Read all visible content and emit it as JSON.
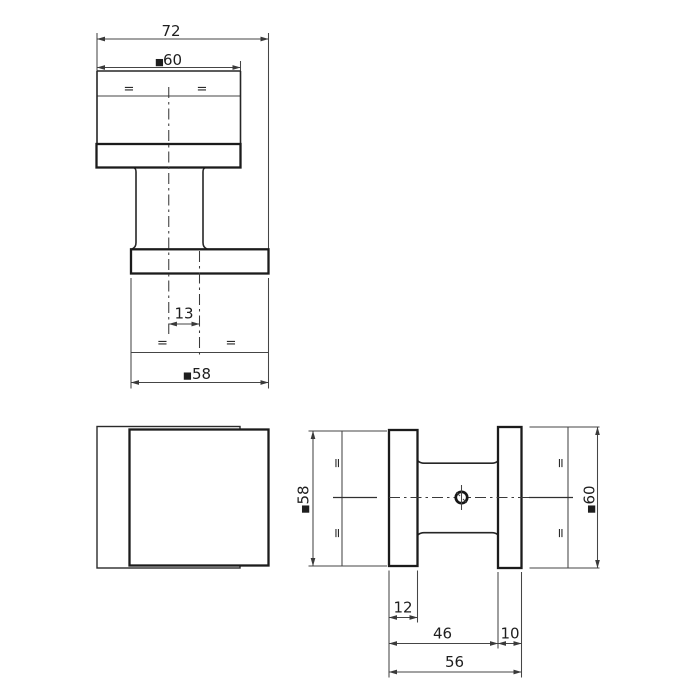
{
  "colors": {
    "background": "#ffffff",
    "object_line": "#1b1b1b",
    "dimension_line": "#454545",
    "text": "#1e1e1e"
  },
  "views": {
    "top_view": {
      "dims": {
        "overall_width": "72",
        "square_sym": "■",
        "rose_width": "60",
        "center_offset": "13",
        "knob_width": "58",
        "equal": "="
      }
    },
    "front_view": {},
    "side_view": {
      "dims": {
        "square_sym": "■",
        "knob_face": "58",
        "rose_face": "60",
        "knob_thickness": "12",
        "knob_depth_to_rose": "46",
        "rose_thickness": "10",
        "overall_depth": "56",
        "equal": "="
      }
    }
  }
}
